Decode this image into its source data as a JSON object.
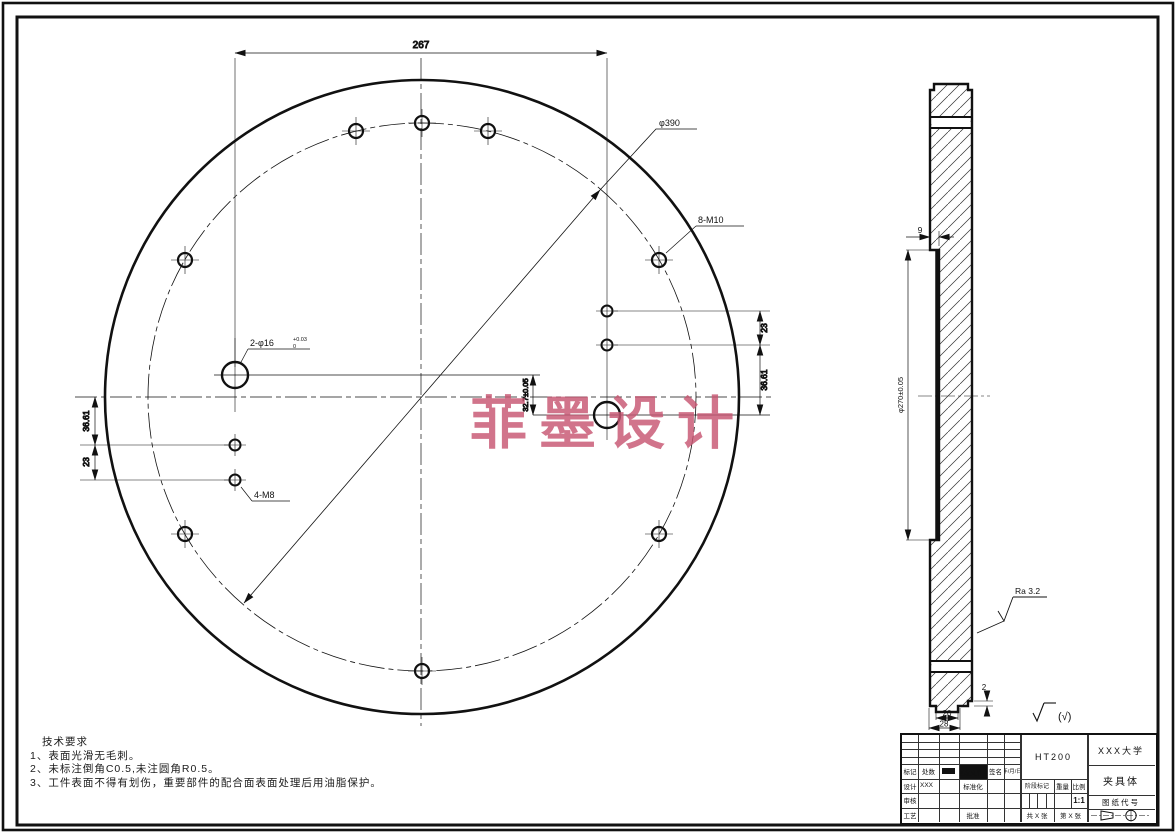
{
  "watermark": "菲墨设计",
  "watermark_color": "#c75672",
  "tech": {
    "title": "技术要求",
    "item1": "1、表面光滑无毛刺。",
    "item2": "2、未标注倒角C0.5,未注圆角R0.5。",
    "item3": "3、工件表面不得有划伤，重要部件的配合面表面处理后用油脂保护。"
  },
  "front": {
    "dim_width": "267",
    "dim_bolt_circle": "φ390",
    "label_m10": "8-M10",
    "label_pin": "2-φ16",
    "pin_tol_sup": "+0.03",
    "pin_tol_sub": "0",
    "dim_offset": "32.7±0.05",
    "dim_right_upper": "23",
    "dim_right_lower": "36.61",
    "dim_left_upper": "36.61",
    "dim_left_lower": "23",
    "label_m8": "4-M8"
  },
  "side": {
    "dim_recess_depth": "9",
    "dim_bore": "φ270±0.05",
    "dim_roughness": "Ra 3.2",
    "dim_step": "2",
    "dim_tab": "20",
    "dim_base": "28"
  },
  "finish_note": "(√)",
  "title_block": {
    "material": "HT200",
    "company": "XXX大学",
    "part_name": "夹具体",
    "drawing_no_label": "图纸代号",
    "rev_row": {
      "c1": "标记",
      "c2": "处数",
      "c4": "更改文件号",
      "c5": "签名",
      "c6": "年/月/日"
    },
    "design_row": {
      "c1": "设计",
      "c2": "XXX",
      "c4": "标准化"
    },
    "check_row": {
      "c1": "审核"
    },
    "process_row": {
      "c1": "工艺",
      "c4": "批准"
    },
    "stage_label": "阶段标记",
    "weight_label": "重量",
    "scale_label": "比例",
    "scale_value": "1:1",
    "sheets": "共 X 张",
    "sheet_no": "第 X 张"
  }
}
